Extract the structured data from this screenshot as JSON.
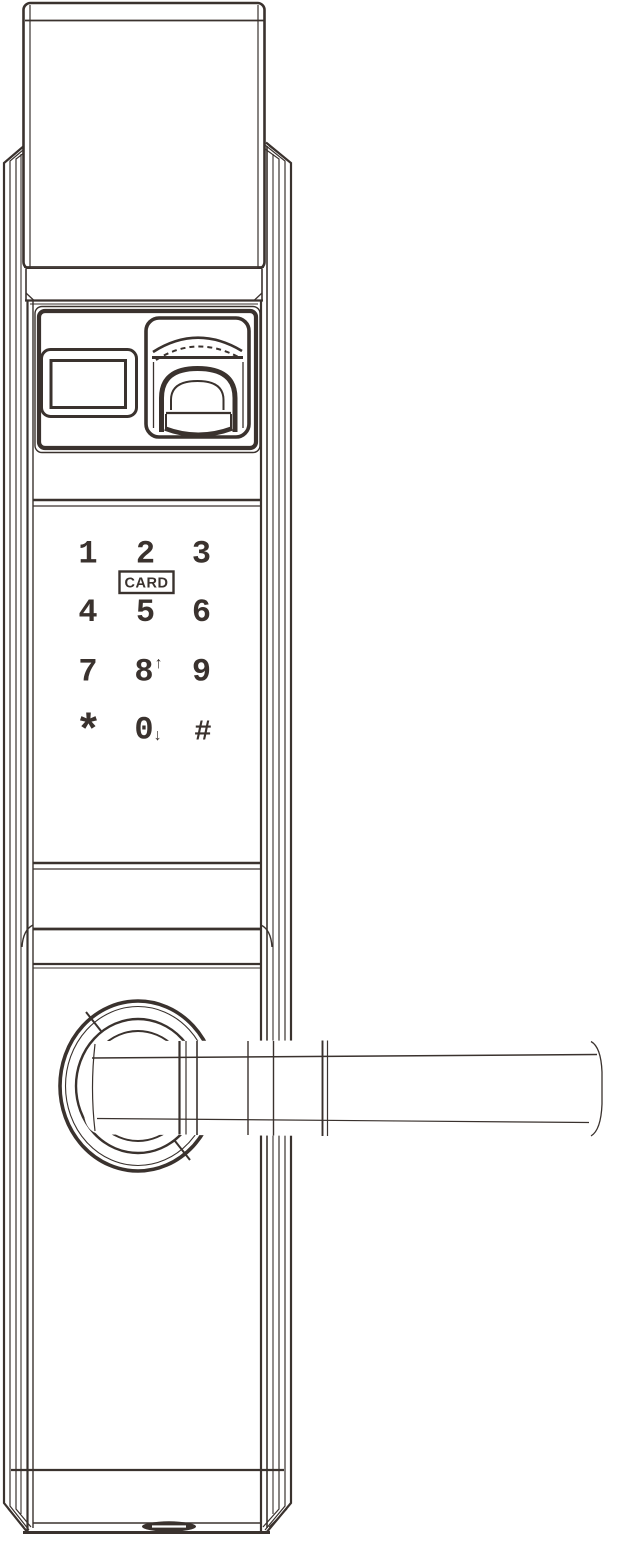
{
  "drawing": {
    "subject": "smart-door-lock-front-view",
    "style": "technical-line-drawing"
  },
  "colors": {
    "line": "#3a322e",
    "background": "#ffffff"
  },
  "keypad": {
    "card_label": "CARD",
    "keys": [
      {
        "label": "1"
      },
      {
        "label": "2"
      },
      {
        "label": "3"
      },
      {
        "label": "4"
      },
      {
        "label": "5"
      },
      {
        "label": "6"
      },
      {
        "label": "7"
      },
      {
        "label": "8",
        "arrow": "↑"
      },
      {
        "label": "9"
      },
      {
        "label": "*"
      },
      {
        "label": "0",
        "arrow": "↓"
      },
      {
        "label": "#"
      }
    ]
  },
  "components": {
    "top_cap": "battery-cover-cap",
    "status_display": "display-window",
    "fingerprint_reader": "fingerprint-sensor-with-cover",
    "card_reader": "card-swipe-zone",
    "handle": "lever-handle",
    "rosette": "handle-rosette",
    "bottom_port": "bottom-port-slot"
  }
}
